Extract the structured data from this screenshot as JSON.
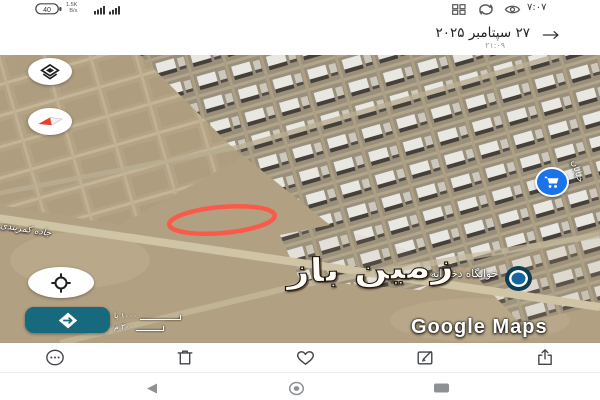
{
  "status_bar": {
    "battery_percent": "40",
    "net_speed_top": "1.5K",
    "net_speed_bottom": "B/s",
    "time": "۷:۰۷",
    "icons": [
      "battery-icon",
      "signal-bars-icon",
      "grid-icon",
      "sync-icon",
      "eye-comfort-icon"
    ]
  },
  "header": {
    "title": "۲۷ سپتامبر ۲۰۲۵",
    "subtitle": "۲۱:۰۹"
  },
  "map": {
    "watermark": "زمین باز",
    "attribution": "Google Maps",
    "scale_feet": "۱۰۰۰ پا",
    "scale_meters": "۲۰۰ م",
    "road_label": "جاده کمربندی",
    "poi_label": "خوابگاه دخترانه",
    "street_label": "خیابان",
    "colors": {
      "annotation_red": "#ff5546",
      "fab_teal": "#176a7d",
      "cart_poi_blue": "#1a73e8",
      "dorm_poi_navy": "#0d3c55"
    }
  },
  "toolbar": {
    "icons": [
      "more-icon",
      "delete-icon",
      "favorite-icon",
      "edit-icon",
      "share-icon"
    ]
  },
  "navbar": {
    "icons": [
      "back-icon",
      "home-icon",
      "recents-icon"
    ]
  }
}
